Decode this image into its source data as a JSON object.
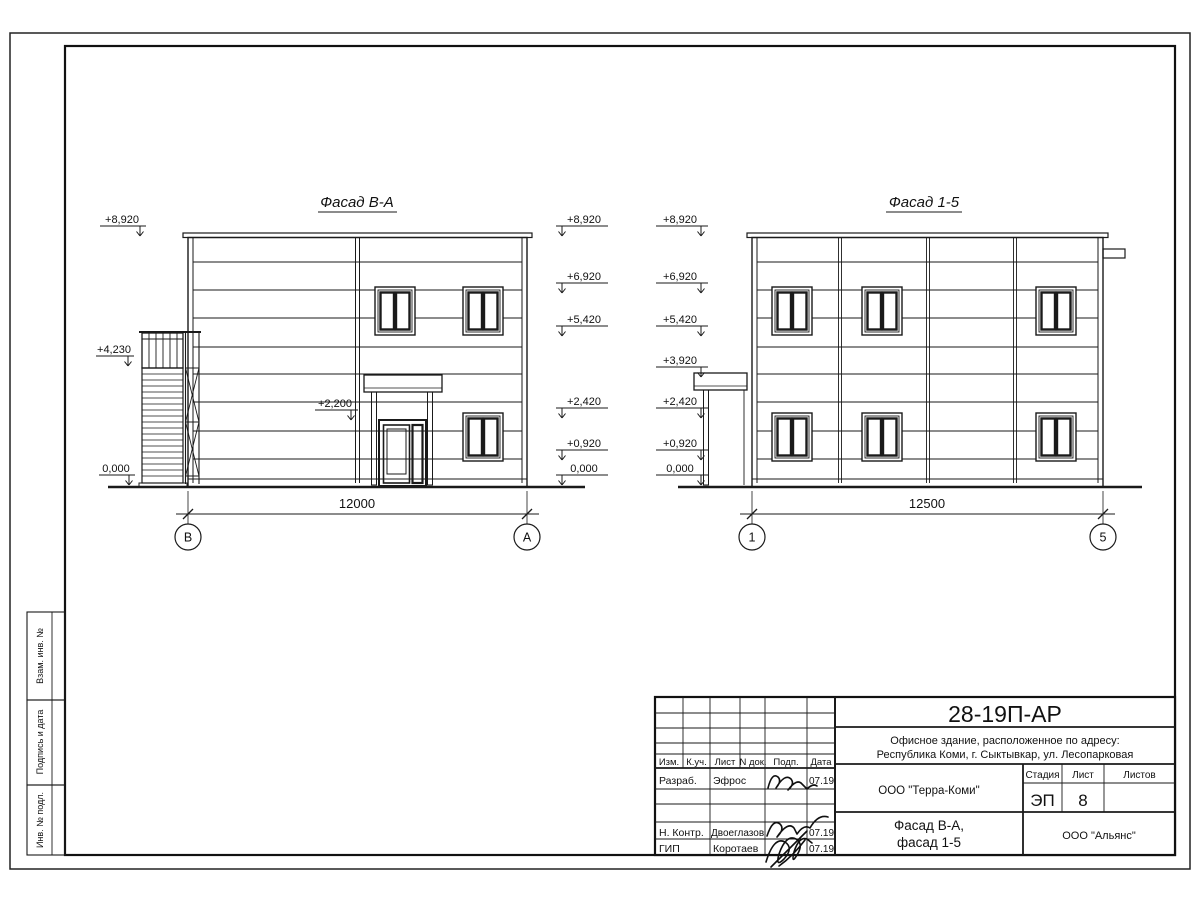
{
  "colors": {
    "line": "#1a1a1a",
    "signature_blue": "#2222dd"
  },
  "facade_ba": {
    "title": "Фасад В-А",
    "dimension": "12000",
    "axes": [
      "В",
      "А"
    ],
    "marks_left": [
      "+8,920",
      "+4,230",
      "0,000"
    ],
    "mark_door": "+2,200",
    "marks_right": [
      "+8,920",
      "+6,920",
      "+5,420",
      "+2,420",
      "+0,920",
      "0,000"
    ]
  },
  "facade_15": {
    "title": "Фасад 1-5",
    "dimension": "12500",
    "axes": [
      "1",
      "5"
    ],
    "marks_left": [
      "+8,920",
      "+6,920",
      "+5,420",
      "+3,920",
      "+2,420",
      "+0,920",
      "0,000"
    ]
  },
  "sheet": {
    "code": "28-19П-АР",
    "object_line1": "Офисное здание, расположенное по адресу:",
    "object_line2": "Республика Коми, г. Сыктывкар, ул. Лесопарковая",
    "org": "ООО \"Терра-Коми\"",
    "drawing_title_line1": "Фасад В-А,",
    "drawing_title_line2": "фасад 1-5",
    "contractor": "ООО \"Альянс\"",
    "stage_label": "Стадия",
    "stage": "ЭП",
    "sheet_label": "Лист",
    "sheet_no": "8",
    "sheets_label": "Листов",
    "header_cols": [
      "Изм.",
      "К.уч.",
      "Лист",
      "N док.",
      "Подп.",
      "Дата"
    ],
    "rows": [
      {
        "role": "Разраб.",
        "name": "Эфрос",
        "date": "07.19"
      },
      {
        "role": "Н. Контр.",
        "name": "Двоеглазов",
        "date": "07.19"
      },
      {
        "role": "ГИП",
        "name": "Коротаев",
        "date": "07.19"
      }
    ],
    "side_labels": [
      "Взам. инв. №",
      "Подпись и дата",
      "Инв. № подл."
    ]
  }
}
